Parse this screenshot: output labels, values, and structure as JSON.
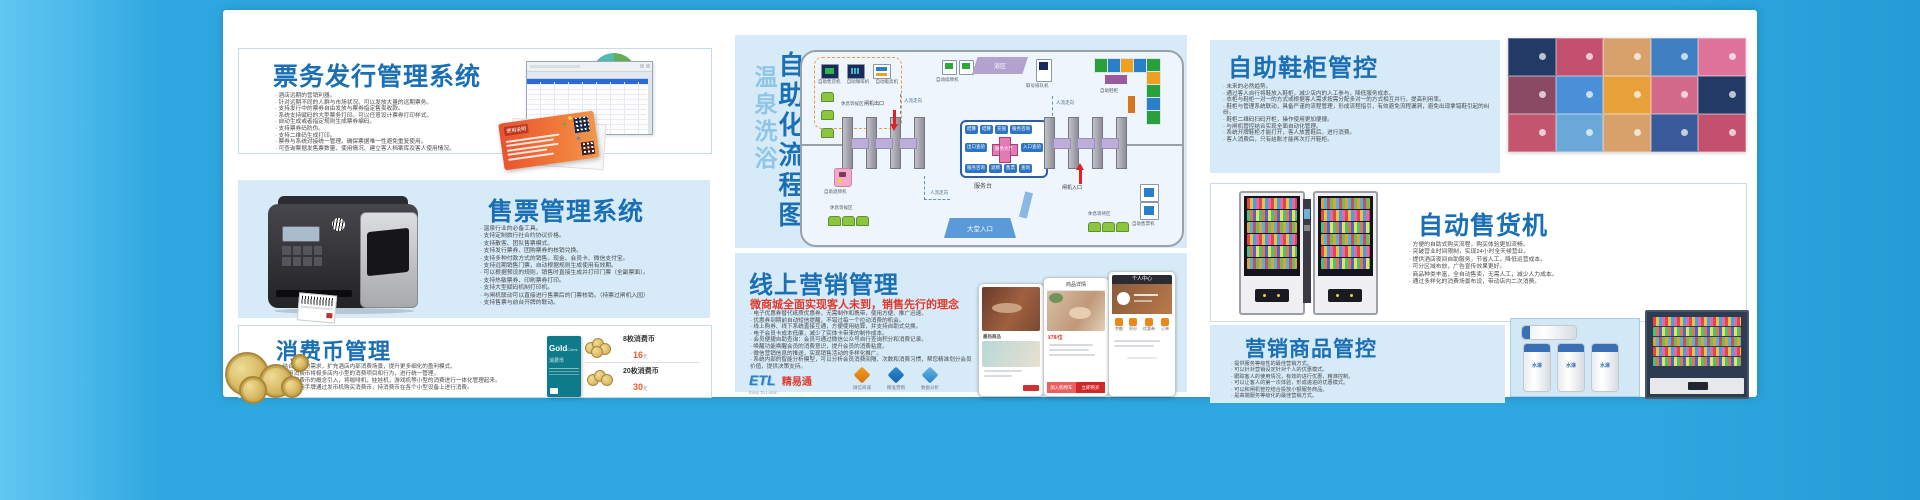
{
  "theme": {
    "outer_blue": "#2ea7e0",
    "panel_blue": "#d6eaf8",
    "title_blue": "#1a6fb5",
    "red": "#e0392b",
    "orange": "#f15a24"
  },
  "ticket_issue": {
    "title": "票务发行管理系统",
    "card_title": "使用说明",
    "bullets": [
      "酒店远期的营销利器。",
      "针对远期不同的人群与市场状况。可以发放大量的远期票务。",
      "支持发行中的票券自由发放与票券指定售卖收款。",
      "系统支持赋码的大型票务打印。可以任意设计票券打印样式。",
      "自动生成或者指定规则生成票券编码。",
      "支持票券码防伪。",
      "支持二维码生成打印。",
      "票券与系统对接统一管理。确保票据唯一性避免重复使用。",
      "可查询票据发售票数量、使用情况、建立客人档案库及客人使用情况。"
    ]
  },
  "ticket_sale": {
    "title": "售票管理系统",
    "bullets": [
      "温泉行业的必备工具。",
      "支持定制旅行社合约协议价格。",
      "支持散客、团队售票模式。",
      "支持发行票券、团购票券的核销兑换。",
      "支持多种付款方式的销售。现金、会员卡、微信支付宝。",
      "支持远期销售门票，自动根据规则生成使用有效期。",
      "可以根据预设的规则，销售时直接生成并打印门票（全副票面）。",
      "支持热敏票券、印刷票券打印。",
      "支持大型赋码机制打印机。",
      "与闸机联动可以直接进行售票后的门票核销。（持票过闸机入园）",
      "支持售票与前台开牌的联动。"
    ]
  },
  "coin": {
    "title": "消费币管理",
    "bullets": [
      "结合消费的需求，扩充酒店内部消费场景，提升更多细化的盈利模式。",
      "利用消费币将极多店内小型的消费项目和行为，进行统一管理。",
      "利用消费币的概念引入，将咖啡机，娃娃机，游戏机等小型的消费进行一体化管理起来。",
      "客人利用手牌通过发币机购买消费币，持消费币在各个小型设备上进行消费。"
    ],
    "card": {
      "brand": "Gold",
      "brand2": "Coins",
      "name": "消费币"
    },
    "prices": [
      {
        "name": "8枚消费币",
        "value": "16",
        "unit": "元"
      },
      {
        "name": "20枚消费币",
        "value": "30",
        "unit": "元"
      }
    ]
  },
  "flow": {
    "title_light": "温泉洗浴",
    "title_bold": "自助化流程图",
    "machine_labels": [
      "自助售货机",
      "自助咖啡机",
      "自动贩卖机"
    ],
    "rest_area_1": "休息等候区",
    "renew_machine": "自动续牌机",
    "bath_zone": "浴区",
    "queue_machine": "取号排队机",
    "flow_dir": "人流走向",
    "shoe_locker": "自助鞋柜",
    "gate_exit": "闸机出口",
    "gate_entry": "闸机入口",
    "service_desk": "服务台",
    "lobby_entry": "大堂入口",
    "return_machine": "自助退牌机",
    "rest_area_2": "休息等候区",
    "rest_area_3": "休息等待区",
    "ticket_machine": "自助售票机",
    "service_hall": "服务大厅",
    "mini_top": [
      "结算",
      "结算",
      "充值",
      "服务咨询"
    ],
    "mini_left": "出口查验",
    "mini_right": "入口查验",
    "mini_bottom": [
      "服务咨询",
      "退牌",
      "售票",
      "查询"
    ]
  },
  "marketing": {
    "title": "线上营销管理",
    "subtitle": "微商城全面实现客人未到，销售先行的理念",
    "bullets": [
      "电子优惠券替代纸质优惠券，无需制作和携带，使用方便、推广迅速。",
      "优惠券到期前自动短信提醒，不错过每一个拉动消费的机会。",
      "线上购券、线下系统直接互通，方便使用结算，并支持自助式兑换。",
      "电子会员卡成本低廉，减少了实体卡带来的制作成本。",
      "会员便捷自助查询：会员可通过微信公众号自行查询积分和消费记录。",
      "唤醒功能唤醒会员的消费意识，提升会员的消费粘度。",
      "微信营销信息的推送，实现销售活动的多样化推广。",
      "系统内部的智能分析模型，可以分析会员消费间隔、次数和消费习惯，帮您精准划分会员价值，提供决策支持。"
    ],
    "logo": {
      "text": "ETL",
      "name": "精易通",
      "slogan": "Easy To Learn"
    },
    "features": [
      "微信商城",
      "精准营销",
      "数据分析"
    ],
    "phones": {
      "hot_label": "最热商品",
      "detail_title": "商品详情",
      "price": "¥78/位",
      "cart_btn": "加入购物车",
      "buy_btn": "立即购买",
      "profile_title": "个人中心",
      "profile_icons": [
        "余额",
        "积分",
        "优惠券",
        "订单"
      ]
    }
  },
  "shoe": {
    "title": "自助鞋柜管控",
    "bullets": [
      "未来的必然趋势。",
      "通过客人自行将鞋放入鞋柜，减少店内的人工参与，降低服务成本。",
      "衣柜与鞋柜一对一的方式或根据客人需求按需分配多对一的方式相互并行，提高利用率。",
      "鞋柜与管理系统联动，具备严谨的流程管理，形成流程指引，有效避免流程漏洞，避免出现拿错鞋引起的纠纷。",
      "鞋柜二维码扫码开柜，操作使用更加便捷。",
      "与闸机管控结合实现全面自动化管理。",
      "系统开牌鞋柜才能打开，客人放置鞋后，进行消费。",
      "客人消费后，只有结账才能再次打开鞋柜。"
    ]
  },
  "vending": {
    "title": "自动售货机",
    "bullets": [
      "方便的自助式购买流程，购买体验更加流畅。",
      "突破营业时间限制，实现24小时全天候营业。",
      "提供酒店夜间自助服务，节省人工，降低运营成本。",
      "可分区域布放，广告宣传效果更好。",
      "商品种类丰富，全自动售卖，无需人工，减少人力成本。",
      "通过多样化的消费场景布设，带动店内二次消费。"
    ]
  },
  "goods": {
    "title": "营销商品管控",
    "bullets": [
      "提供服务等级性的最佳营销方式。",
      "可以针对营销设定针对个人的优惠模式。",
      "跟踪客人的使用情况，有效的进行优惠，精准控制。",
      "可以让客人的第一次体验，形成递进的优惠模式。",
      "可以和闸机管控结合投放小额服务商品。",
      "是高端服务等级化的最佳营销方式。"
    ],
    "bottle_label": "水淋"
  }
}
